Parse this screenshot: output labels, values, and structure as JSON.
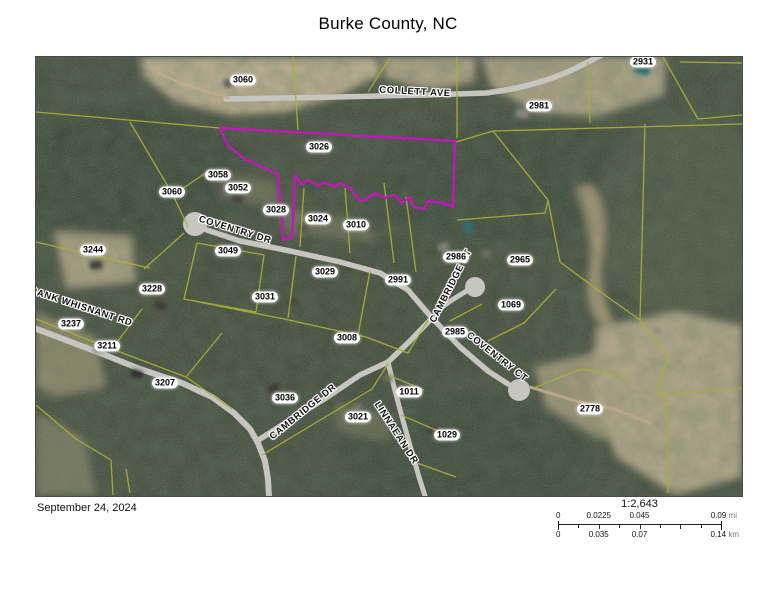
{
  "title": "Burke County, NC",
  "footer": {
    "date": "September 24, 2024",
    "scale_ratio": "1:2,643",
    "scalebar": {
      "mi_labels": [
        "0",
        "0.0225",
        "0.045",
        "0.09"
      ],
      "mi_unit": "mi",
      "km_labels": [
        "0",
        "0.035",
        "0.07",
        "0.14"
      ],
      "km_unit": "km"
    }
  },
  "map": {
    "highlighted_parcel": "3026",
    "colors": {
      "parcel_line": "#a8af33",
      "highlighted_parcel": "#c713c0",
      "road": "#c6c5c0",
      "forest": "#394233",
      "clearing": "#c7b593"
    },
    "parcel_labels": [
      {
        "id": "3060",
        "x": 207,
        "y": 23
      },
      {
        "id": "2931",
        "x": 607,
        "y": 5
      },
      {
        "id": "2981",
        "x": 503,
        "y": 49
      },
      {
        "id": "3026",
        "x": 283,
        "y": 90
      },
      {
        "id": "3058",
        "x": 182,
        "y": 118
      },
      {
        "id": "3052",
        "x": 202,
        "y": 131
      },
      {
        "id": "3060",
        "x": 136,
        "y": 135
      },
      {
        "id": "3028",
        "x": 240,
        "y": 153
      },
      {
        "id": "3024",
        "x": 282,
        "y": 162
      },
      {
        "id": "3010",
        "x": 320,
        "y": 168
      },
      {
        "id": "3244",
        "x": 57,
        "y": 193
      },
      {
        "id": "3049",
        "x": 192,
        "y": 194
      },
      {
        "id": "2986",
        "x": 420,
        "y": 200
      },
      {
        "id": "2965",
        "x": 484,
        "y": 203
      },
      {
        "id": "3029",
        "x": 289,
        "y": 215
      },
      {
        "id": "2991",
        "x": 362,
        "y": 223
      },
      {
        "id": "3228",
        "x": 116,
        "y": 232
      },
      {
        "id": "3031",
        "x": 229,
        "y": 240
      },
      {
        "id": "1069",
        "x": 475,
        "y": 248
      },
      {
        "id": "3237",
        "x": 35,
        "y": 267
      },
      {
        "id": "2985",
        "x": 419,
        "y": 275
      },
      {
        "id": "3008",
        "x": 311,
        "y": 281
      },
      {
        "id": "3211",
        "x": 71,
        "y": 289
      },
      {
        "id": "3207",
        "x": 129,
        "y": 326
      },
      {
        "id": "3036",
        "x": 249,
        "y": 341
      },
      {
        "id": "1011",
        "x": 373,
        "y": 335
      },
      {
        "id": "3021",
        "x": 322,
        "y": 360
      },
      {
        "id": "1029",
        "x": 411,
        "y": 378
      },
      {
        "id": "2778",
        "x": 554,
        "y": 352
      }
    ],
    "street_labels": [
      {
        "name": "COLLETT AVE",
        "x": 379,
        "y": 35,
        "rot": 3
      },
      {
        "name": "COVENTRY DR",
        "x": 199,
        "y": 173,
        "rot": 17
      },
      {
        "name": "FRANK WHISNANT RD",
        "x": 42,
        "y": 249,
        "rot": 18
      },
      {
        "name": "CAMBRIDGE CT",
        "x": 415,
        "y": 229,
        "rot": -63
      },
      {
        "name": "COVENTRY CT",
        "x": 461,
        "y": 300,
        "rot": 38
      },
      {
        "name": "CAMBRIDGE DR",
        "x": 267,
        "y": 355,
        "rot": -39
      },
      {
        "name": "LINNAEAN DR",
        "x": 360,
        "y": 376,
        "rot": 57
      }
    ]
  }
}
